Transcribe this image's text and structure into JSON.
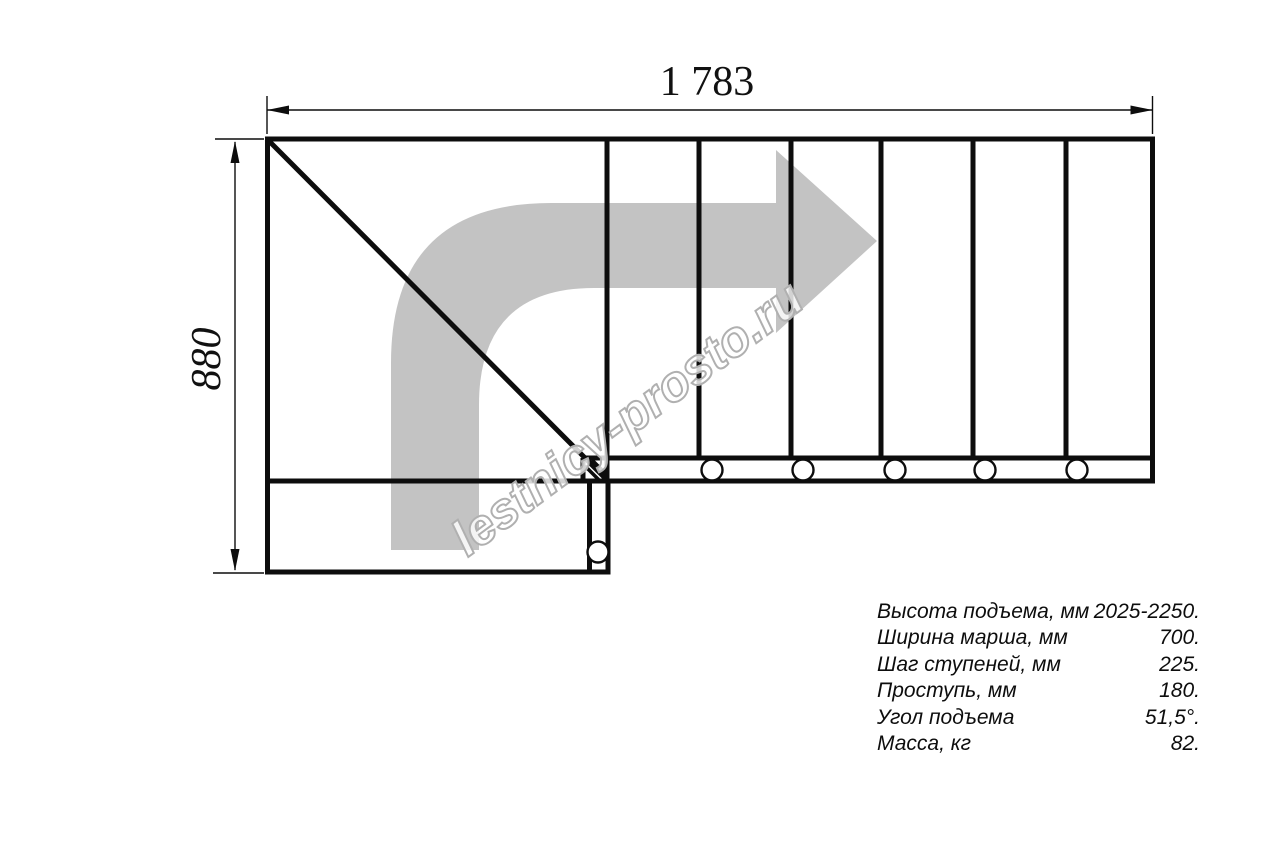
{
  "drawing": {
    "title": "staircase-plan-top-view",
    "dimensions": {
      "width_label": "1 783",
      "height_label": "880"
    },
    "watermark": "lestnicy-prosto.ru",
    "specs": {
      "rows": [
        {
          "label": "Высота подъема, мм",
          "value": "2025-2250."
        },
        {
          "label": "Ширина марша, мм",
          "value": "700."
        },
        {
          "label": "Шаг ступеней, мм",
          "value": "225."
        },
        {
          "label": "Проступь, мм",
          "value": "180."
        },
        {
          "label": "Угол подъема",
          "value": "51,5°."
        },
        {
          "label": "Масса, кг",
          "value": "82."
        }
      ]
    },
    "colors": {
      "line": "#0d0d0d",
      "arrow": "#c3c3c3",
      "watermark_outline": "#b0b0b0",
      "background": "#ffffff"
    }
  }
}
